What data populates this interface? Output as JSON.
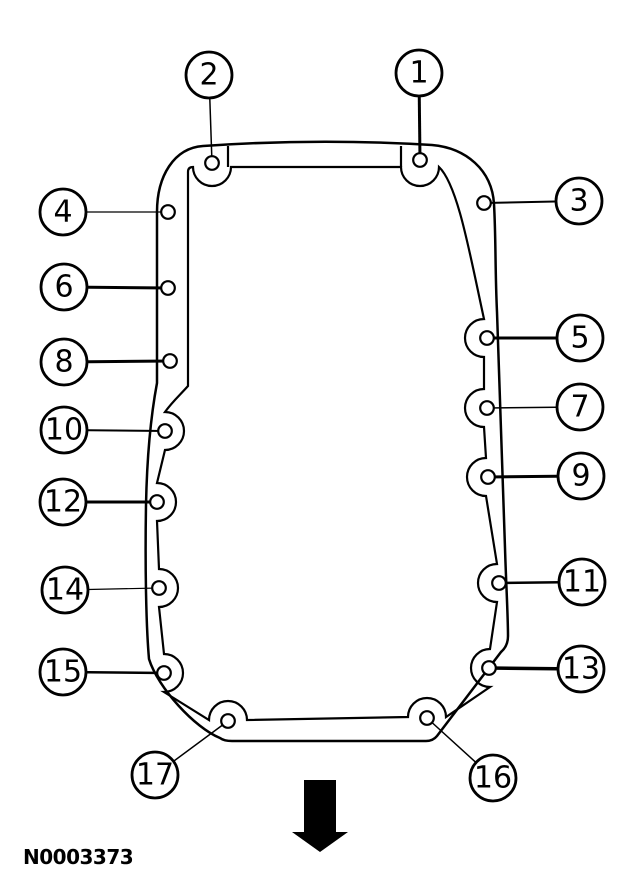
{
  "figure": {
    "label": "N0003373"
  },
  "colors": {
    "line": "#000000",
    "background": "#ffffff"
  },
  "style": {
    "hole_radius": 6.8,
    "callout_radius": 23
  },
  "arrow": {
    "glyph": "down-arrow",
    "direction": "down"
  },
  "callouts": [
    {
      "number": "1",
      "cx": 419,
      "cy": 73,
      "hx": 420,
      "hy": 160,
      "leader_weight": 3
    },
    {
      "number": "2",
      "cx": 209,
      "cy": 75,
      "hx": 212,
      "hy": 163,
      "leader_weight": 1.5
    },
    {
      "number": "3",
      "cx": 579,
      "cy": 201,
      "hx": 484,
      "hy": 203,
      "leader_weight": 2
    },
    {
      "number": "4",
      "cx": 63,
      "cy": 212,
      "hx": 168,
      "hy": 212,
      "leader_weight": 1.2
    },
    {
      "number": "5",
      "cx": 580,
      "cy": 338,
      "hx": 487,
      "hy": 338,
      "leader_weight": 3
    },
    {
      "number": "6",
      "cx": 64,
      "cy": 287,
      "hx": 168,
      "hy": 288,
      "leader_weight": 3
    },
    {
      "number": "7",
      "cx": 580,
      "cy": 407,
      "hx": 487,
      "hy": 408,
      "leader_weight": 1.5
    },
    {
      "number": "8",
      "cx": 64,
      "cy": 362,
      "hx": 170,
      "hy": 361,
      "leader_weight": 3
    },
    {
      "number": "9",
      "cx": 581,
      "cy": 476,
      "hx": 488,
      "hy": 477,
      "leader_weight": 3
    },
    {
      "number": "10",
      "cx": 64,
      "cy": 430,
      "hx": 165,
      "hy": 431,
      "leader_weight": 2
    },
    {
      "number": "11",
      "cx": 582,
      "cy": 582,
      "hx": 499,
      "hy": 583,
      "leader_weight": 2.5
    },
    {
      "number": "12",
      "cx": 63,
      "cy": 502,
      "hx": 157,
      "hy": 502,
      "leader_weight": 3
    },
    {
      "number": "13",
      "cx": 581,
      "cy": 669,
      "hx": 489,
      "hy": 668,
      "leader_weight": 3.5
    },
    {
      "number": "14",
      "cx": 65,
      "cy": 590,
      "hx": 159,
      "hy": 588,
      "leader_weight": 1.2
    },
    {
      "number": "15",
      "cx": 63,
      "cy": 672,
      "hx": 164,
      "hy": 673,
      "leader_weight": 2.5
    },
    {
      "number": "16",
      "cx": 493,
      "cy": 778,
      "hx": 427,
      "hy": 718,
      "leader_weight": 1.5
    },
    {
      "number": "17",
      "cx": 155,
      "cy": 775,
      "hx": 228,
      "hy": 721,
      "leader_weight": 1.5
    }
  ]
}
